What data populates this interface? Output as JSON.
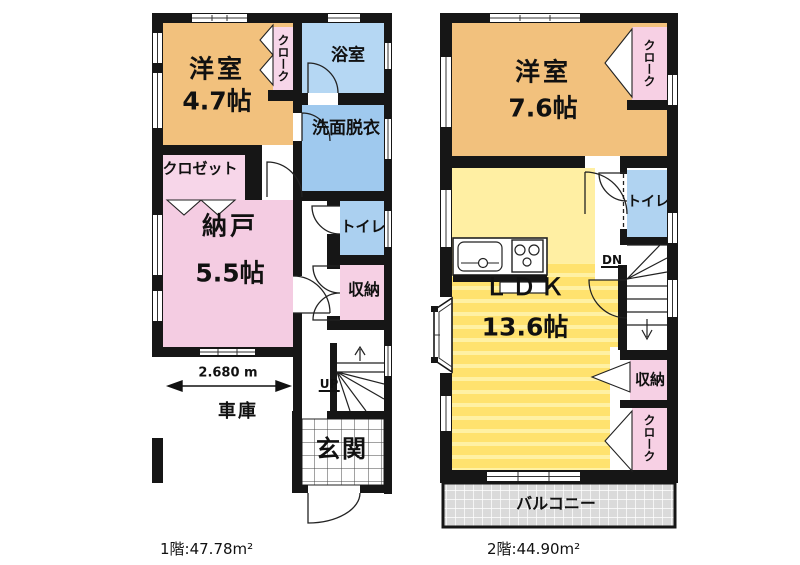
{
  "colors": {
    "wall": "#161616",
    "room_orange": "#F2C17D",
    "room_pink": "#F4CCE2",
    "room_pink_light": "#F7D6E9",
    "room_blue": "#A9CEF0",
    "ldk_yellow": "#FFE26E",
    "kitchen_yellow": "#FFEFA3",
    "balcony_gray": "#DADADA"
  },
  "floor1": {
    "title": "1階:47.78m²",
    "dimension": "2.680 m",
    "stairs_label": "UP",
    "rooms": {
      "western": {
        "name": "洋室",
        "size": "4.7帖"
      },
      "cloak": "クローク",
      "bathroom": "浴室",
      "washroom": "洗面脱衣",
      "closet": "クロゼット",
      "storage_room": {
        "name": "納戸",
        "size": "5.5帖"
      },
      "toilet": "トイレ",
      "storage": "収納",
      "garage": "車庫",
      "entrance": "玄関"
    }
  },
  "floor2": {
    "title": "2階:44.90m²",
    "stairs_label": "DN",
    "rooms": {
      "western": {
        "name": "洋室",
        "size": "7.6帖"
      },
      "cloak_top": "クローク",
      "toilet": "トイレ",
      "ldk": {
        "name": "ＬＤＫ",
        "size": "13.6帖"
      },
      "storage": "収納",
      "cloak_bottom": "クローク",
      "balcony": "バルコニー"
    }
  }
}
